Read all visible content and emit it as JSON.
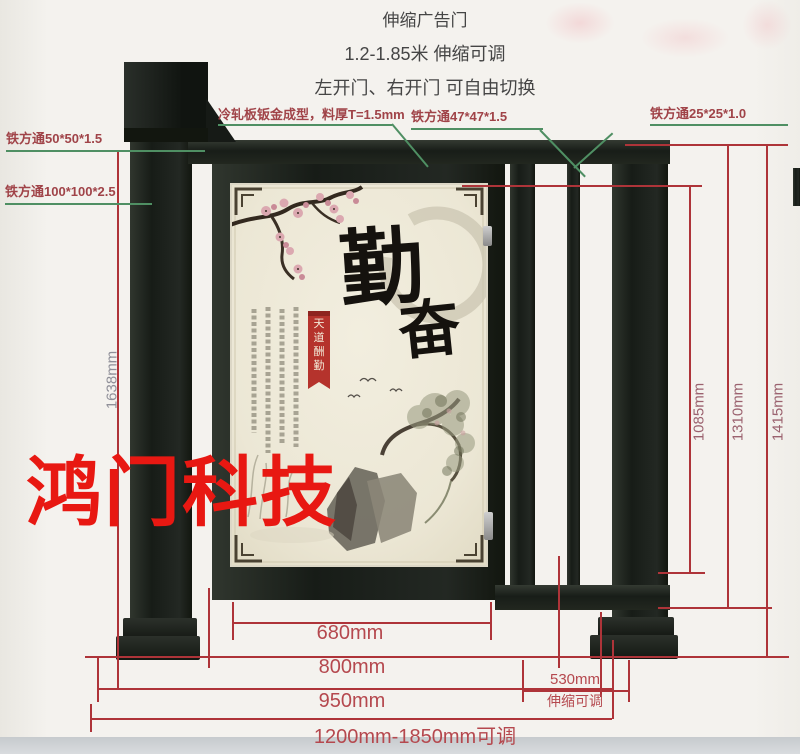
{
  "header": {
    "line1": "伸缩广告门",
    "line2": "1.2-1.85米 伸缩可调",
    "line3": "左开门、右开门 可自由切换"
  },
  "callouts": {
    "tube50": "铁方通50*50*1.5",
    "tube100": "铁方通100*100*2.5",
    "cold_rolled": "冷轧板钣金成型，料厚T=1.5mm",
    "tube47": "铁方通47*47*1.5",
    "tube25": "铁方通25*25*1.0"
  },
  "dimensions": {
    "height_total": "1638mm",
    "height_rail": "1085mm",
    "height_mid": "1310mm",
    "height_post": "1415mm",
    "width_panel": "680mm",
    "width_door": "800mm",
    "width_left": "950mm",
    "width_tele": "530mm",
    "width_tele_note": "伸缩可调",
    "width_range": "1200mm-1850mm可调"
  },
  "watermark": "鸿门科技",
  "poster": {
    "char_main": "勤",
    "char_sub": "奋",
    "seal_chars": [
      "天",
      "道",
      "酬",
      "勤"
    ]
  },
  "colors": {
    "dimension_line": "#ae3439",
    "dimension_text": "#b5484e",
    "callout_text": "#a04348",
    "leader_line": "#4f8f63",
    "watermark": "#e81812",
    "metal_dark": "#1d221c",
    "poster_cream": "#ece7d5",
    "side_label": "#9b626f",
    "height_label": "#8f8f98",
    "title_text": "#454545",
    "banner_red": "#b5332c"
  }
}
